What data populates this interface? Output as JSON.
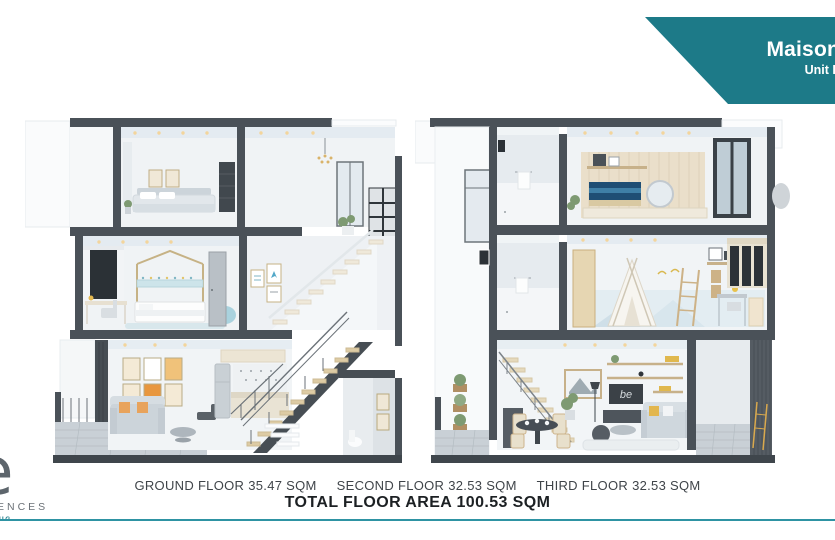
{
  "banner": {
    "title": "Maison",
    "subtitle": "Unit L"
  },
  "footer": {
    "floors": [
      {
        "name": "GROUND FLOOR",
        "area": "35.47 SQM"
      },
      {
        "name": "SECOND FLOOR",
        "area": "32.53 SQM"
      },
      {
        "name": "THIRD FLOOR",
        "area": "32.53 SQM"
      }
    ],
    "total": "TOTAL FLOOR AREA 100.53 SQM"
  },
  "logo": {
    "glyph": "e",
    "residences_fragment": "ENCES",
    "location_fragment": "UG"
  },
  "renders": {
    "wall_board_text": "be",
    "left_building_alt": "Cutaway section render of three-storey maisonette, staircase side",
    "right_building_alt": "Cutaway section render of three-storey maisonette, living side"
  },
  "colors": {
    "accent_teal": "#1d7a88",
    "divider_teal": "#2e93a3",
    "structure_dark": "#4a5158"
  }
}
